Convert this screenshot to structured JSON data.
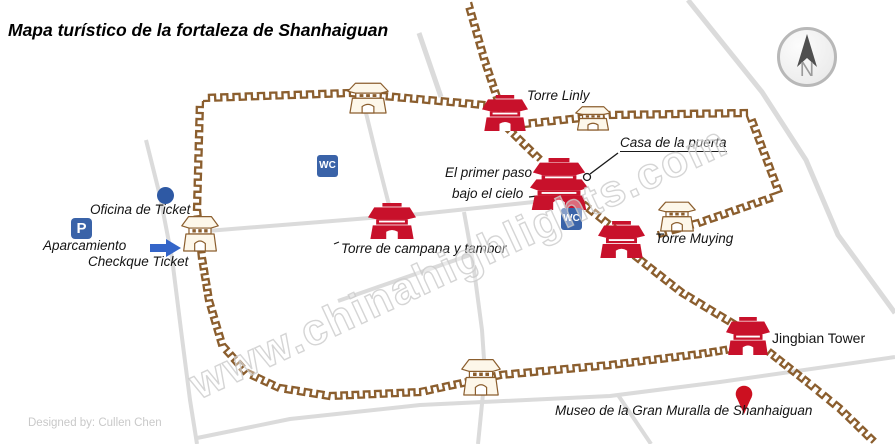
{
  "title": {
    "text": "Mapa turístico de la fortaleza de Shanhaiguan"
  },
  "credit": {
    "text": "Designed by:  Cullen Chen"
  },
  "watermark": {
    "text": "www.chinahighlights.com"
  },
  "compass": {
    "letter": "N"
  },
  "icons": {
    "wc_label": "WC",
    "parking_label": "P"
  },
  "labels": {
    "torre_linly": {
      "text": "Torre Linly"
    },
    "casa_de_la_puerta": {
      "text": "Casa de la puerta"
    },
    "el_primer_paso_line1": {
      "text": "El primer paso"
    },
    "el_primer_paso_line2": {
      "text": "bajo el cielo"
    },
    "torre_campana": {
      "text": "Torre de campana y tambor"
    },
    "torre_muying": {
      "text": "Torre Muying"
    },
    "jingbian": {
      "text": "Jingbian Tower"
    },
    "museo": {
      "text": "Museo de la Gran Muralla de Shanhaiguan"
    },
    "oficina": {
      "text": "Oficina  de Ticket"
    },
    "aparcamiento": {
      "text": "Aparcamiento"
    },
    "checkque": {
      "text": "Checkque Ticket"
    }
  },
  "colors": {
    "wall": "#8b5e2e",
    "tower_red": "#c8112b",
    "tan_fill": "#fdf7ea",
    "road": "#dbdbdb",
    "icon_blue": "#3a63a8",
    "arrow_blue": "#3465c8",
    "pin_red": "#cc1020",
    "pointer_black": "#1a1a1a"
  },
  "map_geometry": {
    "roads": [
      {
        "name": "north-approach-road",
        "width": 5,
        "points": [
          [
            419,
            33
          ],
          [
            441,
            97
          ]
        ]
      },
      {
        "name": "north-gate-road",
        "width": 4,
        "points": [
          [
            366,
            113
          ],
          [
            377,
            158
          ],
          [
            389,
            205
          ]
        ]
      },
      {
        "name": "west-road",
        "width": 4,
        "points": [
          [
            146,
            140
          ],
          [
            160,
            196
          ],
          [
            172,
            258
          ],
          [
            181,
            330
          ],
          [
            190,
            400
          ],
          [
            197,
            444
          ]
        ]
      },
      {
        "name": "main-east-west-road",
        "width": 4,
        "points": [
          [
            207,
            231
          ],
          [
            320,
            222
          ],
          [
            420,
            214
          ],
          [
            543,
            201
          ]
        ]
      },
      {
        "name": "south-gate-road",
        "width": 4,
        "points": [
          [
            464,
            212
          ],
          [
            473,
            262
          ],
          [
            482,
            330
          ],
          [
            485,
            374
          ],
          [
            478,
            444
          ]
        ]
      },
      {
        "name": "diagonal-branch-road",
        "width": 4,
        "points": [
          [
            338,
            301
          ],
          [
            470,
            255
          ]
        ]
      },
      {
        "name": "south-outer-road",
        "width": 4,
        "points": [
          [
            197,
            438
          ],
          [
            290,
            419
          ],
          [
            420,
            405
          ],
          [
            610,
            396
          ],
          [
            720,
            382
          ],
          [
            895,
            357
          ]
        ]
      },
      {
        "name": "museum-branch-road",
        "width": 4,
        "points": [
          [
            618,
            395
          ],
          [
            651,
            444
          ]
        ]
      },
      {
        "name": "northeast-diagonal-road",
        "width": 5,
        "points": [
          [
            688,
            0
          ],
          [
            762,
            92
          ],
          [
            806,
            160
          ],
          [
            838,
            235
          ],
          [
            895,
            313
          ]
        ]
      }
    ],
    "walls": [
      {
        "name": "great-wall-north",
        "side": 1,
        "points": [
          [
            471,
            2
          ],
          [
            487,
            58
          ],
          [
            505,
            112
          ]
        ]
      },
      {
        "name": "fortress-north-wall",
        "side": -1,
        "points": [
          [
            203,
            101
          ],
          [
            350,
            96
          ],
          [
            484,
            108
          ]
        ]
      },
      {
        "name": "fortress-west-south-wall",
        "side": 1,
        "points": [
          [
            203,
            101
          ],
          [
            200,
            210
          ],
          [
            205,
            258
          ],
          [
            212,
            300
          ],
          [
            225,
            344
          ],
          [
            248,
            370
          ],
          [
            280,
            385
          ],
          [
            330,
            393
          ],
          [
            420,
            389
          ],
          [
            500,
            372
          ],
          [
            610,
            362
          ],
          [
            700,
            351
          ],
          [
            731,
            346
          ]
        ]
      },
      {
        "name": "east-wall-upper",
        "side": -1,
        "points": [
          [
            495,
            120
          ],
          [
            537,
            161
          ]
        ]
      },
      {
        "name": "east-wall-mid",
        "side": -1,
        "points": [
          [
            577,
            203
          ],
          [
            616,
            234
          ]
        ]
      },
      {
        "name": "east-wall-lower",
        "side": -1,
        "points": [
          [
            624,
            251
          ],
          [
            680,
            295
          ],
          [
            733,
            327
          ]
        ]
      },
      {
        "name": "great-wall-southeast",
        "side": -1,
        "points": [
          [
            763,
            351
          ],
          [
            806,
            385
          ],
          [
            838,
            411
          ],
          [
            871,
            443
          ]
        ]
      },
      {
        "name": "gate-enclosure-wall",
        "side": -1,
        "points": [
          [
            524,
            127
          ],
          [
            610,
            118
          ],
          [
            747,
            116
          ],
          [
            776,
            193
          ],
          [
            698,
            220
          ],
          [
            658,
            231
          ]
        ]
      }
    ],
    "towers": [
      {
        "name": "tower-el-primer-paso",
        "kind": "red2",
        "x": 530,
        "y": 158,
        "w": 58,
        "h": 52
      },
      {
        "name": "tower-torre-linly",
        "kind": "red",
        "x": 482,
        "y": 95,
        "w": 46,
        "h": 36
      },
      {
        "name": "tower-campana-tambor",
        "kind": "red",
        "x": 368,
        "y": 203,
        "w": 48,
        "h": 36
      },
      {
        "name": "tower-torre-muying",
        "kind": "red",
        "x": 598,
        "y": 221,
        "w": 47,
        "h": 37
      },
      {
        "name": "tower-jingbian",
        "kind": "red",
        "x": 726,
        "y": 317,
        "w": 44,
        "h": 38
      },
      {
        "name": "north-gate-tower",
        "kind": "tan",
        "x": 347,
        "y": 81,
        "w": 42,
        "h": 32
      },
      {
        "name": "west-gate-tower",
        "kind": "tan",
        "x": 181,
        "y": 214,
        "w": 38,
        "h": 37
      },
      {
        "name": "south-gate-tower",
        "kind": "tan",
        "x": 461,
        "y": 357,
        "w": 40,
        "h": 38
      },
      {
        "name": "enclosure-north-tower",
        "kind": "tan",
        "x": 575,
        "y": 105,
        "w": 36,
        "h": 25
      },
      {
        "name": "enclosure-east-tower",
        "kind": "tan",
        "x": 658,
        "y": 200,
        "w": 38,
        "h": 31
      }
    ],
    "markers": {
      "museum_pin": {
        "cx": 744,
        "cy": 394,
        "r": 8.3,
        "tip_y": 414
      },
      "check-arrow": {
        "points": [
          [
            150,
            244
          ],
          [
            166,
            244
          ],
          [
            166,
            239
          ],
          [
            181,
            248
          ],
          [
            166,
            257
          ],
          [
            166,
            252
          ],
          [
            150,
            252
          ]
        ]
      },
      "casa_pointer": {
        "line": [
          [
            618,
            153
          ],
          [
            590,
            174
          ]
        ],
        "circle": [
          587,
          177,
          3.5
        ]
      },
      "cielo_dash": {
        "line": [
          [
            529,
            197
          ],
          [
            537,
            196
          ]
        ]
      },
      "campana_tick": {
        "line": [
          [
            334,
            244
          ],
          [
            339,
            242
          ]
        ]
      }
    }
  }
}
